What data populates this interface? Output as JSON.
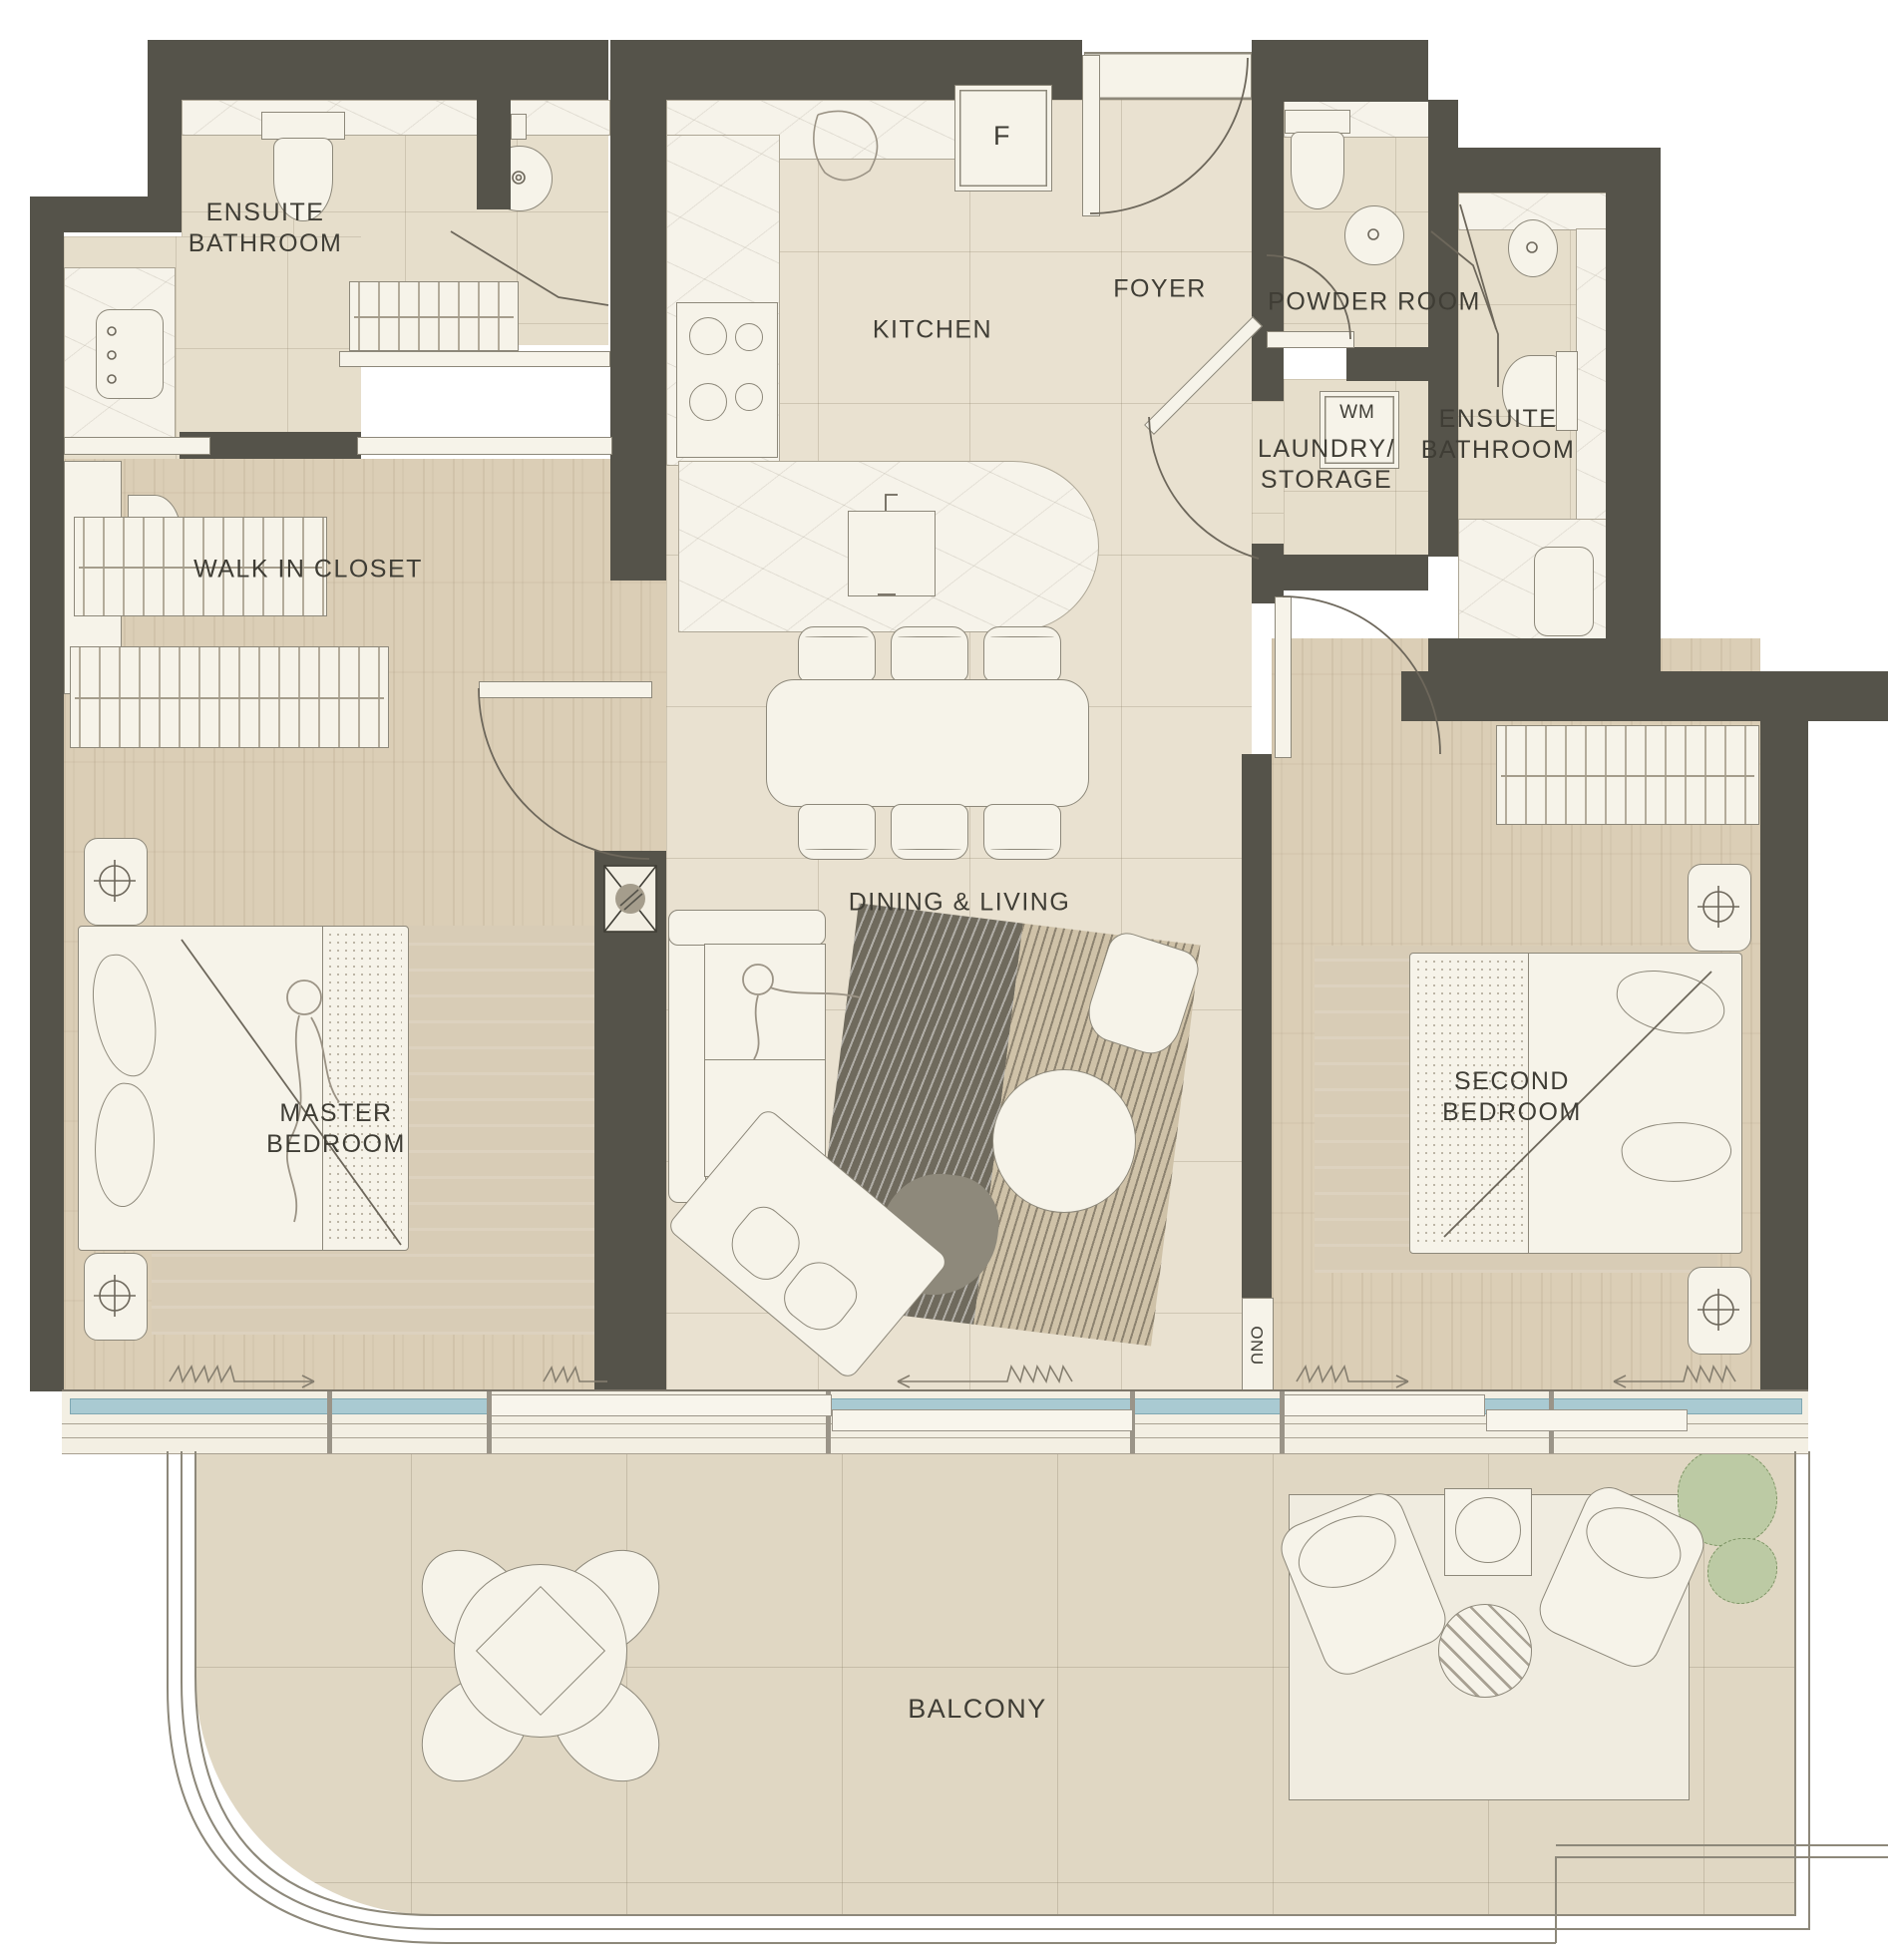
{
  "title": "Two-bedroom apartment floor plan",
  "colors": {
    "wall": "#55534a",
    "tile": "#e9e1d0",
    "bath": "#e6decb",
    "wood": "#dbceb6",
    "marble": "#f6f3ea",
    "fixture": "#f6f3e9",
    "outline": "#8d887a",
    "glass": "#a9cad2",
    "balcony": "#e0d7c3",
    "rugdark": "#6f6a5d",
    "rugtan": "#cfc2a8",
    "plant": "#bccaa4",
    "text": "#3f3d35"
  },
  "rooms": [
    {
      "name": "ensuite-bathroom-1",
      "label": "ENSUITE\nBATHROOM"
    },
    {
      "name": "walk-in-closet",
      "label": "WALK IN CLOSET"
    },
    {
      "name": "kitchen",
      "label": "KITCHEN"
    },
    {
      "name": "foyer",
      "label": "FOYER"
    },
    {
      "name": "powder-room",
      "label": "POWDER ROOM"
    },
    {
      "name": "laundry-storage",
      "label": "LAUNDRY/\nSTORAGE"
    },
    {
      "name": "ensuite-bathroom-2",
      "label": "ENSUITE\nBATHROOM"
    },
    {
      "name": "master-bedroom",
      "label": "MASTER\nBEDROOM"
    },
    {
      "name": "dining-living",
      "label": "DINING & LIVING"
    },
    {
      "name": "second-bedroom",
      "label": "SECOND\nBEDROOM"
    },
    {
      "name": "balcony",
      "label": "BALCONY"
    }
  ],
  "appliances": {
    "fridge": "F",
    "washing_machine": "WM",
    "utility": "ONU"
  }
}
